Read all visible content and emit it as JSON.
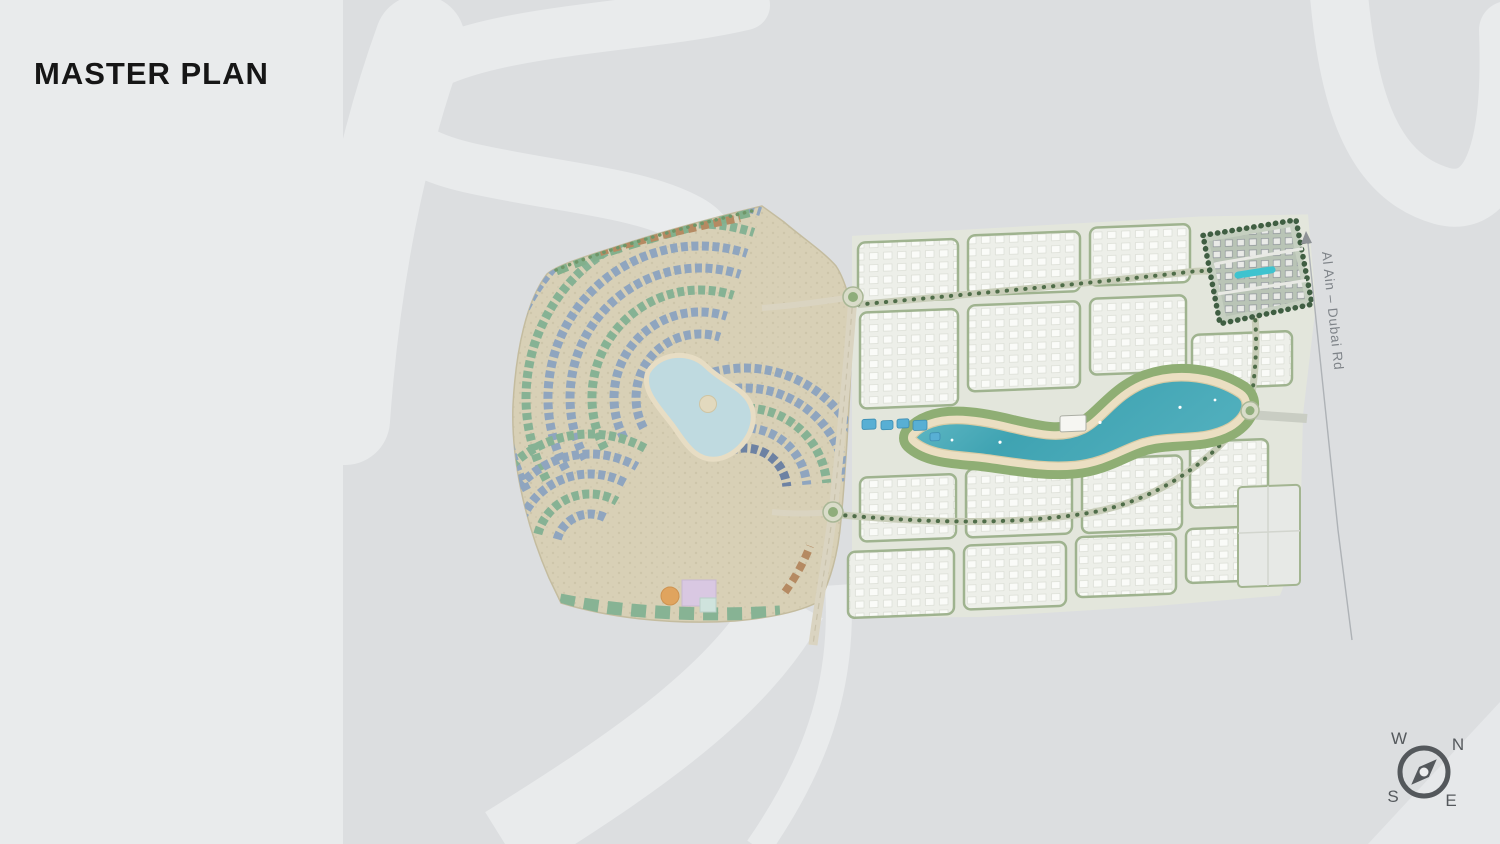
{
  "slide": {
    "title": "MASTER PLAN"
  },
  "map": {
    "road_label": "Al Ain – Dubai Rd",
    "compass": {
      "north": "N",
      "east": "E",
      "south": "S",
      "west": "W"
    },
    "colors": {
      "background": "#DCDEE0",
      "ribbon": "#E9EBEC",
      "established_village_base": "#D8D0B6",
      "roof_blue": "#8FA5BF",
      "roof_navy": "#6D82A3",
      "roof_green": "#86B294",
      "roof_brown": "#B28766",
      "new_phase_block": "#F6F7F4",
      "landscape_green": "#8FAE74",
      "tree_green": "#4F6D49",
      "lagoon_teal": "#3FA3B2",
      "lagoon_pale": "#BFDAE0",
      "sand": "#EBDFC2",
      "road": "#DAD4C1",
      "compass": "#54585C",
      "title_text": "#161616",
      "road_label_text": "#7E8388"
    }
  }
}
